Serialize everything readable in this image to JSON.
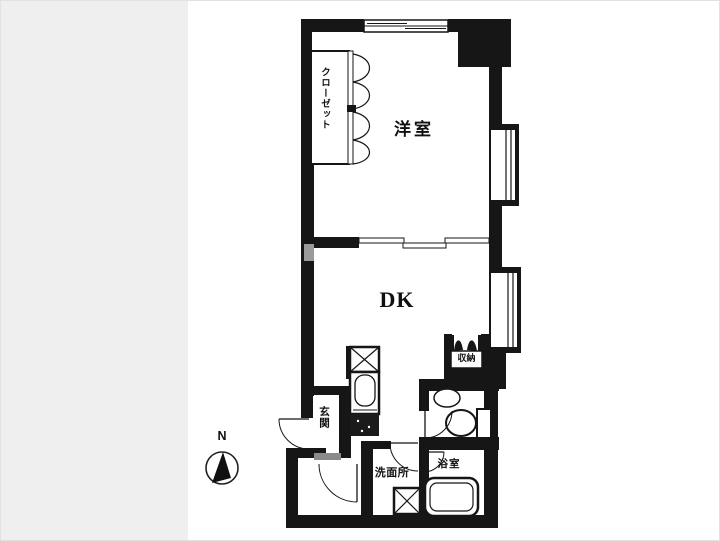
{
  "page": {
    "background": "#ffffff",
    "left_band_color": "#efefef",
    "wall_color": "#161616",
    "step_color": "#8a8a8a"
  },
  "floorplan": {
    "labels": {
      "closet": "クローゼット",
      "western_room": "洋室",
      "dining_kitchen": "DK",
      "storage": "収納",
      "entrance": "玄関",
      "washroom": "洗面所",
      "bathroom": "浴室"
    },
    "compass": {
      "north": "N"
    }
  }
}
